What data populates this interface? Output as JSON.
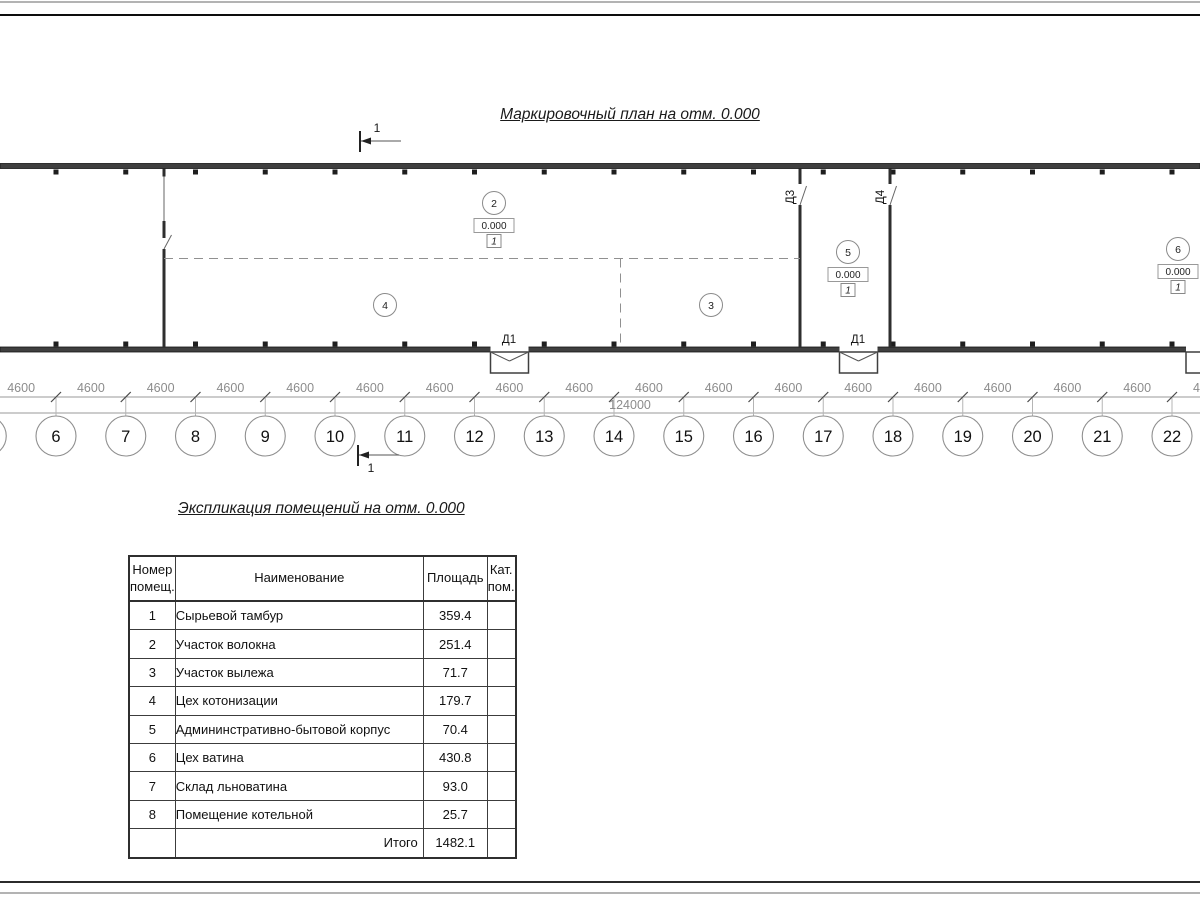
{
  "plan": {
    "title": "Маркировочный план на отм. 0.000",
    "section_label": "1",
    "dim_segment_label": "4600",
    "dim_total_label": "124000",
    "axis_labels": [
      "6",
      "7",
      "8",
      "9",
      "10",
      "11",
      "12",
      "13",
      "14",
      "15",
      "16",
      "17",
      "18",
      "19",
      "20",
      "21",
      "22"
    ],
    "door_labels": [
      {
        "text": "Д1",
        "x": 509,
        "y": 343,
        "rotate": 0
      },
      {
        "text": "Д1",
        "x": 858,
        "y": 343,
        "rotate": 0
      },
      {
        "text": "Д3",
        "x": 794,
        "y": 197,
        "rotate": -90
      },
      {
        "text": "Д4",
        "x": 884,
        "y": 197,
        "rotate": -90
      }
    ],
    "rooms": [
      {
        "number": "2",
        "x": 494,
        "y": 203,
        "elevation": "0.000",
        "category": "1"
      },
      {
        "number": "3",
        "x": 711,
        "y": 305
      },
      {
        "number": "4",
        "x": 385,
        "y": 305
      },
      {
        "number": "5",
        "x": 848,
        "y": 252,
        "elevation": "0.000",
        "category": "1"
      },
      {
        "number": "6",
        "x": 1178,
        "y": 249,
        "elevation": "0.000",
        "category": "1"
      }
    ]
  },
  "table": {
    "title": "Экспликация помещений на отм. 0.000",
    "headers": [
      "Номер\nпомещ.",
      "Наименование",
      "Площадь",
      "Кат.\nпом."
    ],
    "rows": [
      [
        "1",
        "Сырьевой тамбур",
        "359.4"
      ],
      [
        "2",
        "Участок волокна",
        "251.4"
      ],
      [
        "3",
        "Участок вылежа",
        "71.7"
      ],
      [
        "4",
        "Цех котонизации",
        "179.7"
      ],
      [
        "5",
        "Админинстративно-бытовой корпус",
        "70.4"
      ],
      [
        "6",
        "Цех ватина",
        "430.8"
      ],
      [
        "7",
        "Склад льноватина",
        "93.0"
      ],
      [
        "8",
        "Помещение котельной",
        "25.7"
      ]
    ],
    "total_label": "Итого",
    "total_value": "1482.1"
  }
}
